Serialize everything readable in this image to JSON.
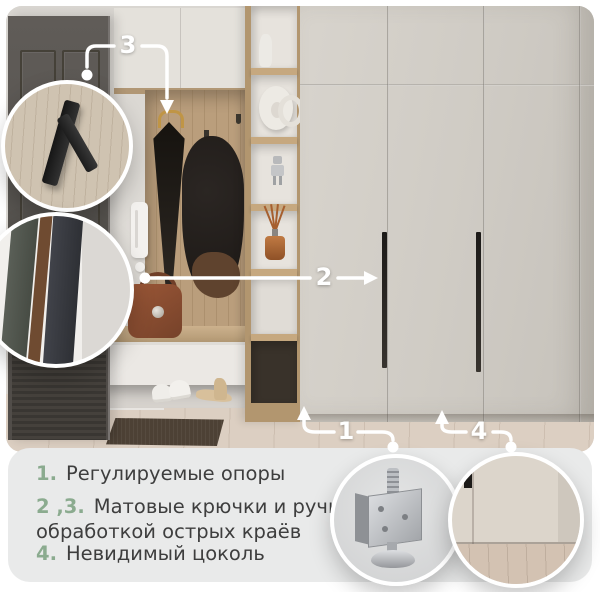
{
  "callouts": {
    "c1": {
      "label": "1"
    },
    "c2": {
      "label": "2"
    },
    "c3": {
      "label": "3"
    },
    "c4": {
      "label": "4"
    }
  },
  "legend": {
    "items": [
      {
        "num": "1.",
        "text": "Регулируемые опоры"
      },
      {
        "num": "2 ,3.",
        "text": "Матовые крючки и ручки с обработкой острых краёв"
      },
      {
        "num": "4.",
        "text": "Невидимый цоколь"
      }
    ]
  },
  "insets": {
    "hook": "matte-hook-closeup",
    "handle": "handle-edge-closeup",
    "support": "adjustable-support-closeup",
    "plinth": "invisible-plinth-closeup"
  },
  "colors": {
    "accent_green": "#8bab8f",
    "text_dark": "#3e3e3e",
    "panel_bg": "#e9eaea",
    "callout_white": "#ffffff"
  }
}
